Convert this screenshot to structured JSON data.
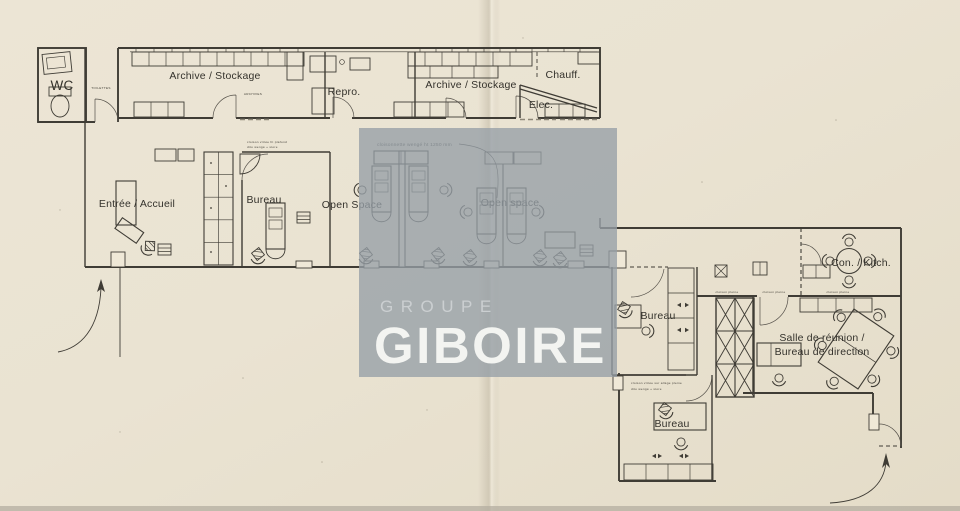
{
  "document": {
    "type": "scanned office floor plan",
    "watermark": {
      "line1": "GROUPE",
      "line2": "GIBOIRE"
    }
  },
  "rooms": {
    "wc": "WC",
    "toilettes_small": "TOILETTES",
    "archive_stockage_1": "Archive / Stockage",
    "archives_small": "ARCHIVES",
    "repro": "Repro.",
    "archive_stockage_2": "Archive / Stockage",
    "chauff": "Chauff.",
    "elec": "Elec.",
    "entree_accueil": "Entrée / Accueil",
    "bureau_1": "Bureau",
    "open_space_1": "Open Space",
    "open_space_2": "Open space",
    "bureau_2": "Bureau",
    "con_kitch": "Con. / Kitch.",
    "salle_reunion_line1": "Salle de réunion /",
    "salle_reunion_line2": "Bureau de direction",
    "bureau_3": "Bureau"
  },
  "annotations": {
    "cloisonnette": "cloisonnette wengé ht 1250 mm",
    "cloison_pleine_1": "cloison pleine",
    "cloison_pleine_2": "cloison pleine",
    "cloison_pleine_3": "cloison pleine",
    "bureau1_note_line1": "cloison vitrée ht plafond",
    "bureau1_note_line2": "dito wengé + store",
    "bureau3_note_line1": "cloison vitrée sur allège pleine",
    "bureau3_note_line2": "dito wengé + store"
  },
  "colors": {
    "paper": "#eae3d2",
    "ink": "#3f3c35",
    "watermark_overlay": "#96a0a8",
    "watermark_text": "#f3f4f1"
  }
}
